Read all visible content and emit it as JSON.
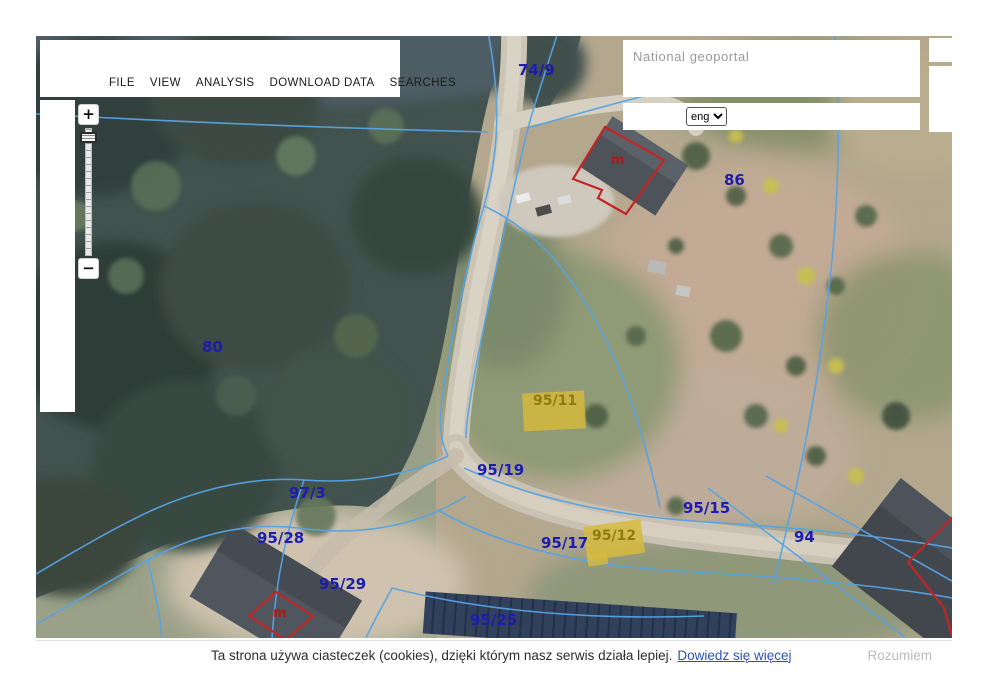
{
  "menu": {
    "items": [
      "FILE",
      "VIEW",
      "ANALYSIS",
      "DOWNLOAD DATA",
      "SEARCHES"
    ]
  },
  "search": {
    "placeholder": "National geoportal"
  },
  "language": {
    "selected": "eng"
  },
  "zoom_control": {
    "zoom_in": "+",
    "zoom_out": "−"
  },
  "map": {
    "colors": {
      "parcel_line": "#57a3e3",
      "parcel_label": "#1c1cae",
      "building_outline": "#c32525",
      "highlight_fill": "#d7b93a",
      "highlight_label": "#8f7a14"
    },
    "labels": [
      {
        "label": "74/9",
        "x": 482,
        "y": 25,
        "type": "blue"
      },
      {
        "label": "86",
        "x": 688,
        "y": 135,
        "type": "blue"
      },
      {
        "label": "80",
        "x": 166,
        "y": 302,
        "type": "blue"
      },
      {
        "label": "95/11",
        "x": 497,
        "y": 357,
        "type": "highlight"
      },
      {
        "label": "95/19",
        "x": 441,
        "y": 425,
        "type": "blue"
      },
      {
        "label": "97/3",
        "x": 253,
        "y": 448,
        "type": "blue"
      },
      {
        "label": "95/28",
        "x": 221,
        "y": 493,
        "type": "blue"
      },
      {
        "label": "95/17",
        "x": 505,
        "y": 498,
        "type": "blue"
      },
      {
        "label": "95/12",
        "x": 556,
        "y": 492,
        "type": "highlight"
      },
      {
        "label": "95/15",
        "x": 647,
        "y": 463,
        "type": "blue"
      },
      {
        "label": "94",
        "x": 758,
        "y": 492,
        "type": "blue"
      },
      {
        "label": "95/29",
        "x": 283,
        "y": 539,
        "type": "blue"
      },
      {
        "label": "95/25",
        "x": 434,
        "y": 575,
        "type": "blue"
      },
      {
        "label": "m",
        "x": 575,
        "y": 117,
        "type": "building"
      },
      {
        "label": "m",
        "x": 237,
        "y": 570,
        "type": "building"
      }
    ]
  },
  "cookie_bar": {
    "message": "Ta strona używa ciasteczek (cookies), dzięki którym nasz serwis działa lepiej.",
    "link": "Dowiedz się więcej",
    "button": "Rozumiem"
  }
}
